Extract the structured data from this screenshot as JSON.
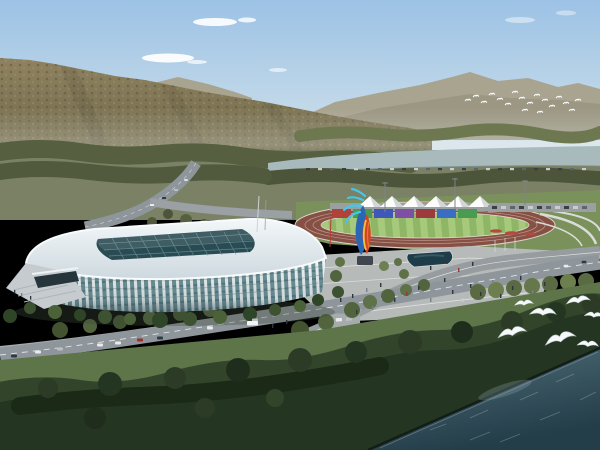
{
  "scene": {
    "kind": "architectural-rendering",
    "view": "aerial view of a white lattice-ribbed sports arena beside an athletic track, plaza and riverfront, with forested mountains behind",
    "elements": [
      {
        "name": "sky",
        "description": "clear pale-blue sky with thin white clouds"
      },
      {
        "name": "forested-mountain",
        "description": "large olive-brown tree-covered mountain slope on the left"
      },
      {
        "name": "distant-mountain-range",
        "description": "hazy grey-green ridge line on the right horizon"
      },
      {
        "name": "river-strip",
        "description": "grey-teal river band in the middle distance"
      },
      {
        "name": "stadium",
        "description": "white arena with vertical rib facade, teal glass and dark gridded skylight roof"
      },
      {
        "name": "entrance-ramp",
        "description": "grey stair ramp at the stadium left entrance"
      },
      {
        "name": "athletic-track",
        "description": "brick-red oval running track with white lane lines"
      },
      {
        "name": "striped-infield",
        "description": "light/dark green striped field inside the track"
      },
      {
        "name": "grandstand-panels",
        "description": "row of red, green, blue and purple panels behind the track"
      },
      {
        "name": "canopy-tents",
        "description": "row of white pyramid canopy tents above the stand"
      },
      {
        "name": "sculpture",
        "description": "tall abstract sculpture with cyan, blue, red and yellow ribbons"
      },
      {
        "name": "plaza",
        "description": "light grey pedestrian plaza with a dark reflecting pool and tiny figures"
      },
      {
        "name": "roads",
        "description": "curving grey boulevards with cars and a white bus"
      },
      {
        "name": "riverfront-forest",
        "description": "dark dense tree band along the shoreline"
      },
      {
        "name": "water",
        "description": "dark teal river filling the lower-right corner"
      },
      {
        "name": "seagulls",
        "description": "white gulls flying over the shoreline trees"
      },
      {
        "name": "distant-bird-flock",
        "description": "small flock of white birds in front of the far ridge"
      }
    ]
  },
  "counts": {
    "canopy_tents": 6,
    "stand_panels": 7,
    "seagulls": 7,
    "distant_birds": 18
  },
  "palette": {
    "sky-top": "#9cc2e5",
    "sky-horizon": "#e4e8e2",
    "cloud": "#ffffff",
    "far-mountain": "#a8a490",
    "far-mountain-shadow": "#97947f",
    "mountain-hi": "#8f8260",
    "mountain-lo": "#6b6647",
    "treeband-dark": "#4c5539",
    "treeband-mid": "#565f3f",
    "treeband-light": "#6d7850",
    "grass-pale": "#7a8165",
    "grass-mid": "#5e7449",
    "lawn-green": "#7b915c",
    "river": "#a9babc",
    "road": "#8f969b",
    "road-light": "#b9bec1",
    "road-line": "#f0f2f3",
    "plaza": "#b6bab8",
    "pond": "#1f3d49",
    "track": "#875045",
    "infield-a": "#8fb566",
    "infield-b": "#a6c97c",
    "panel-red": "#b0423a",
    "panel-green": "#4a9a52",
    "panel-blue": "#3f58b8",
    "panel-purple": "#7e4fa4",
    "panel-blue2": "#3a6ec2",
    "panel-darkred": "#9c3a3e",
    "tent-light": "#fdfdfd",
    "tent-shade": "#d2d6d9",
    "roof-light": "#f3f7f9",
    "roof-dark": "#cdd9df",
    "skylight": "#2b4b53",
    "skylight-grid": "#68969c",
    "rib-white": "#f1f6f7",
    "glass-teal": "#6f949a",
    "glass-band": "#577b81",
    "facade-shade": "#274048",
    "entrance-dark": "#26343c",
    "ramp": "#c6cbcf",
    "sculpt-blue": "#2a66b4",
    "sculpt-cyan": "#45c6ea",
    "sculpt-red": "#d44427",
    "sculpt-yellow": "#f2c03a",
    "sculpt-base": "#3f464d",
    "forest-dark": "#243521",
    "forest-mid": "#32452a",
    "forest-deep": "#1b2917",
    "water-light": "#52707a",
    "water-deep": "#233d49",
    "bird-white": "#f6f9fa",
    "car-white": "#e8eaec",
    "car-dark": "#2f3a46",
    "car-red": "#9e2f2a",
    "car-silver": "#b9bfc4",
    "car-blue": "#27477e"
  }
}
